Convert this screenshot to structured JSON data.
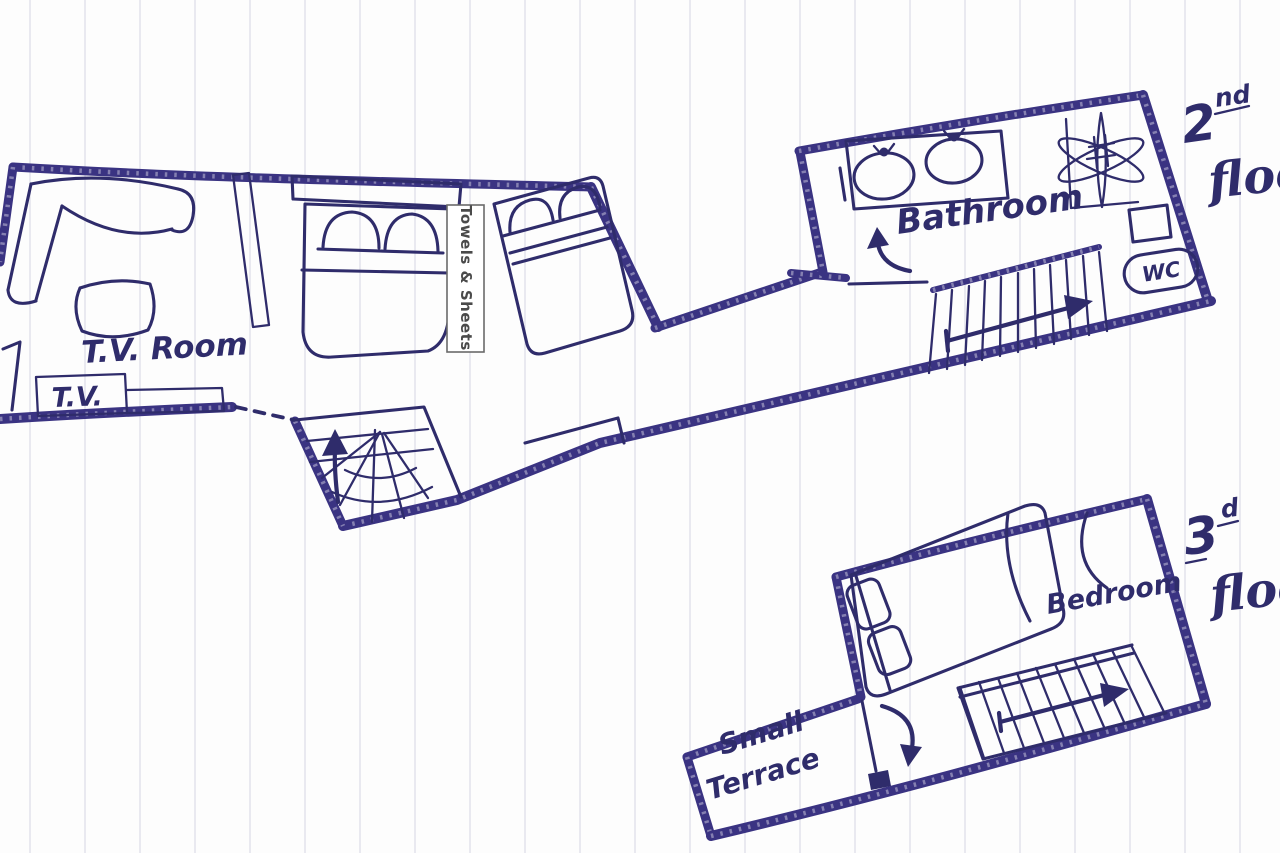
{
  "plan": {
    "ink_color": "#3a3382",
    "line_color": "#2f2c6b",
    "paper_color": "#fdfdfd",
    "rule_color": "#e9e9f0",
    "floors": {
      "second": {
        "tag": {
          "number": "2",
          "suffix": "nd",
          "word": "floor"
        },
        "labels": {
          "tv_room": "T.V. Room",
          "tv": "T.V.",
          "towels_sheets": "Towels & Sheets",
          "bathroom": "Bathroom",
          "wc": "WC"
        }
      },
      "third": {
        "tag": {
          "number": "3",
          "suffix": "d",
          "word": "floor"
        },
        "labels": {
          "bedroom": "Bedroom",
          "terrace_line1": "Small",
          "terrace_line2": "Terrace"
        }
      }
    }
  }
}
